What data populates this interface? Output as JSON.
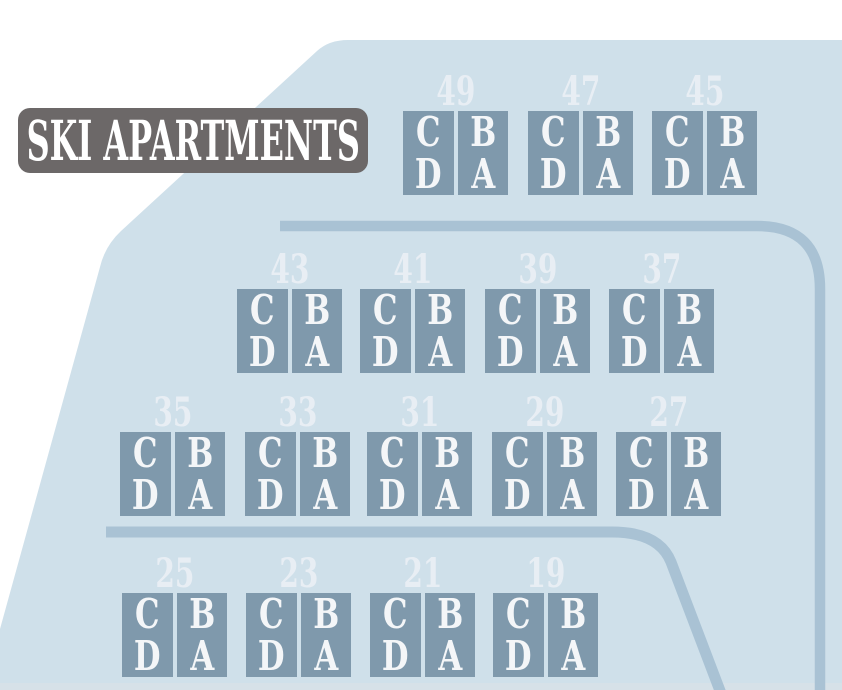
{
  "title": {
    "label": "SKI APARTMENTS"
  },
  "colors": {
    "background": "#ffffff",
    "terrain": "#cfe0ea",
    "building_block": "#7f99ac",
    "road": "#a9c2d4",
    "number_text": "#e8eef4",
    "unit_text": "#f4f6f8",
    "badge_bg": "#6c6868",
    "badge_text": "#ffffff",
    "bottom_strip": "#d6e1e8"
  },
  "map": {
    "buildings": [
      {
        "number": "49",
        "x": 403,
        "y": 111,
        "units": {
          "left": [
            "C",
            "D"
          ],
          "right": [
            "B",
            "A"
          ]
        }
      },
      {
        "number": "47",
        "x": 528,
        "y": 111,
        "units": {
          "left": [
            "C",
            "D"
          ],
          "right": [
            "B",
            "A"
          ]
        }
      },
      {
        "number": "45",
        "x": 652,
        "y": 111,
        "units": {
          "left": [
            "C",
            "D"
          ],
          "right": [
            "B",
            "A"
          ]
        }
      },
      {
        "number": "43",
        "x": 237,
        "y": 289,
        "units": {
          "left": [
            "C",
            "D"
          ],
          "right": [
            "B",
            "A"
          ]
        }
      },
      {
        "number": "41",
        "x": 360,
        "y": 289,
        "units": {
          "left": [
            "C",
            "D"
          ],
          "right": [
            "B",
            "A"
          ]
        }
      },
      {
        "number": "39",
        "x": 485,
        "y": 289,
        "units": {
          "left": [
            "C",
            "D"
          ],
          "right": [
            "B",
            "A"
          ]
        }
      },
      {
        "number": "37",
        "x": 609,
        "y": 289,
        "units": {
          "left": [
            "C",
            "D"
          ],
          "right": [
            "B",
            "A"
          ]
        }
      },
      {
        "number": "35",
        "x": 120,
        "y": 432,
        "units": {
          "left": [
            "C",
            "D"
          ],
          "right": [
            "B",
            "A"
          ]
        }
      },
      {
        "number": "33",
        "x": 245,
        "y": 432,
        "units": {
          "left": [
            "C",
            "D"
          ],
          "right": [
            "B",
            "A"
          ]
        }
      },
      {
        "number": "31",
        "x": 367,
        "y": 432,
        "units": {
          "left": [
            "C",
            "D"
          ],
          "right": [
            "B",
            "A"
          ]
        }
      },
      {
        "number": "29",
        "x": 492,
        "y": 432,
        "units": {
          "left": [
            "C",
            "D"
          ],
          "right": [
            "B",
            "A"
          ]
        }
      },
      {
        "number": "27",
        "x": 616,
        "y": 432,
        "units": {
          "left": [
            "C",
            "D"
          ],
          "right": [
            "B",
            "A"
          ]
        }
      },
      {
        "number": "25",
        "x": 122,
        "y": 593,
        "units": {
          "left": [
            "C",
            "D"
          ],
          "right": [
            "B",
            "A"
          ]
        }
      },
      {
        "number": "23",
        "x": 246,
        "y": 593,
        "units": {
          "left": [
            "C",
            "D"
          ],
          "right": [
            "B",
            "A"
          ]
        }
      },
      {
        "number": "21",
        "x": 370,
        "y": 593,
        "units": {
          "left": [
            "C",
            "D"
          ],
          "right": [
            "B",
            "A"
          ]
        }
      },
      {
        "number": "19",
        "x": 493,
        "y": 593,
        "units": {
          "left": [
            "C",
            "D"
          ],
          "right": [
            "B",
            "A"
          ]
        }
      }
    ]
  }
}
